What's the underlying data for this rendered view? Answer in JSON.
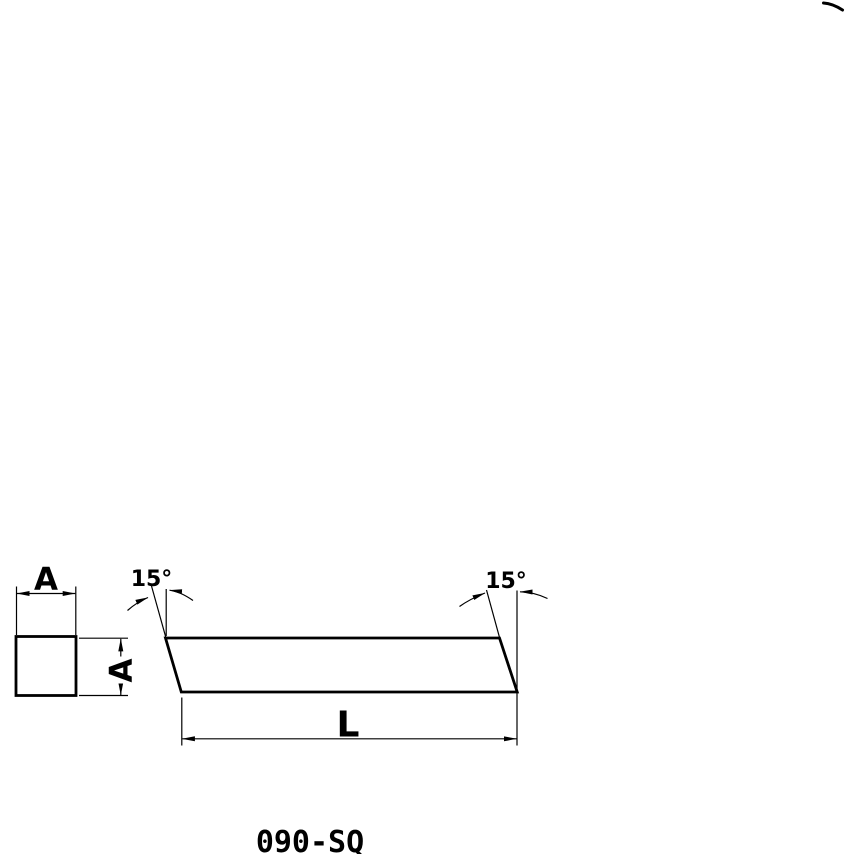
{
  "drawing": {
    "part_number": "090-SQ",
    "dimension_labels": {
      "width_a": "A",
      "height_a": "A",
      "length_l": "L"
    },
    "angle_labels": {
      "left": "15°",
      "right": "15°"
    },
    "colors": {
      "line": "#000000",
      "background": "#ffffff"
    }
  }
}
